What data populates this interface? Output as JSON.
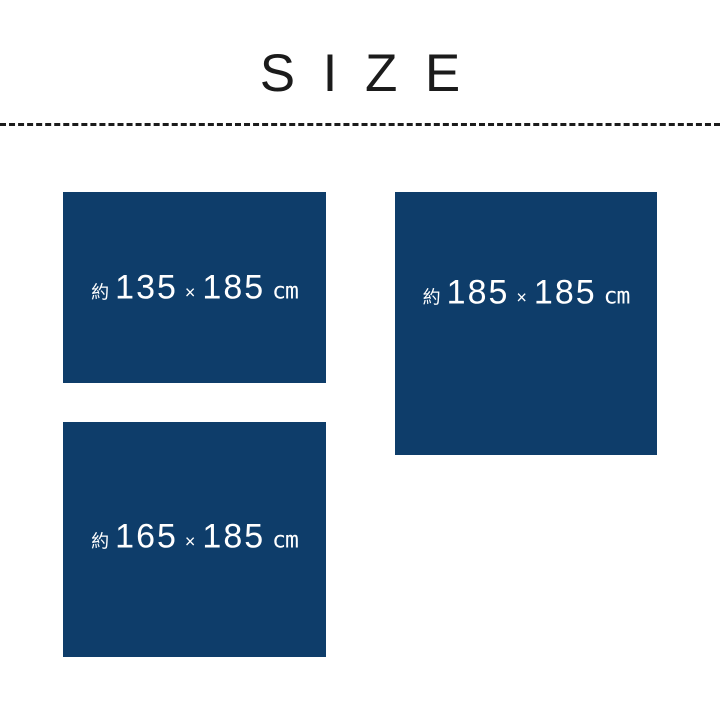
{
  "title": "SIZE",
  "colors": {
    "background": "#ffffff",
    "swatch_fill": "#0e3d6a",
    "label_text": "#ffffff",
    "title_text": "#1b1b1b",
    "divider": "#1b1b1b"
  },
  "divider_style": "dashed",
  "sizes": [
    {
      "prefix": "約",
      "width": "135",
      "multiply": "×",
      "depth": "185",
      "unit": "cm"
    },
    {
      "prefix": "約",
      "width": "185",
      "multiply": "×",
      "depth": "185",
      "unit": "cm"
    },
    {
      "prefix": "約",
      "width": "165",
      "multiply": "×",
      "depth": "185",
      "unit": "cm"
    }
  ]
}
